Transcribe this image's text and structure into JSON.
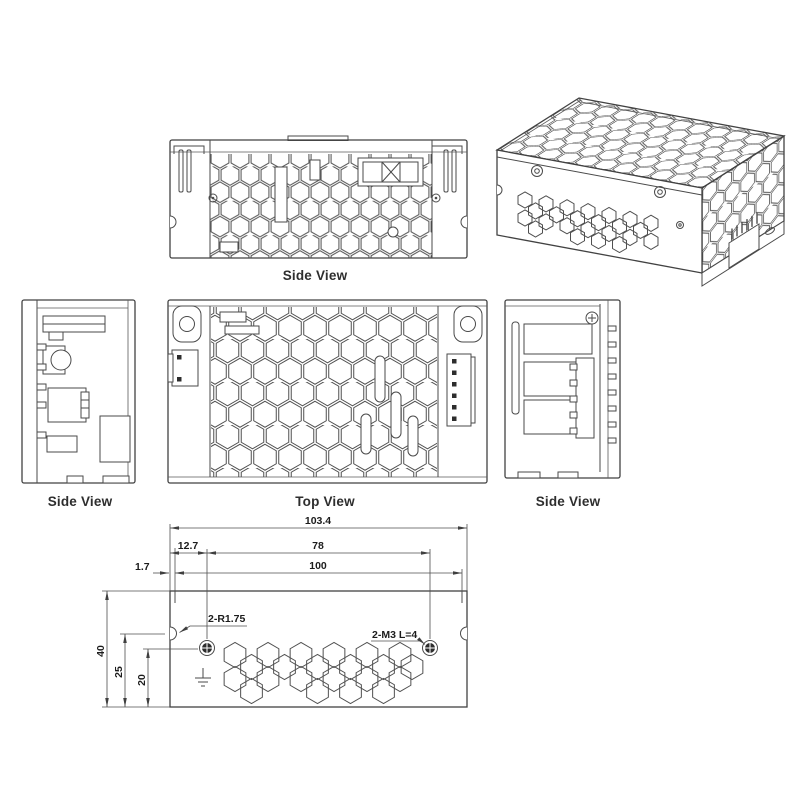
{
  "drawing": {
    "views": {
      "side_view_top": {
        "label": "Side View"
      },
      "side_view_left": {
        "label": "Side View"
      },
      "top_view": {
        "label": "Top View"
      },
      "side_view_right": {
        "label": "Side View"
      }
    },
    "dimensions": {
      "overall_length": "103.4",
      "hole_inset": "12.7",
      "hole_pitch": "78",
      "cover_offset": "1.7",
      "mounting_span": "100",
      "overall_height": "40",
      "notch_center_height": "25",
      "hole_center_height": "20"
    },
    "callouts": {
      "corner_radius": "2-R1.75",
      "mounting_screws": "2-M3 L=4"
    },
    "colors": {
      "line": "#4a4a4a",
      "text": "#1c1c1c"
    }
  }
}
